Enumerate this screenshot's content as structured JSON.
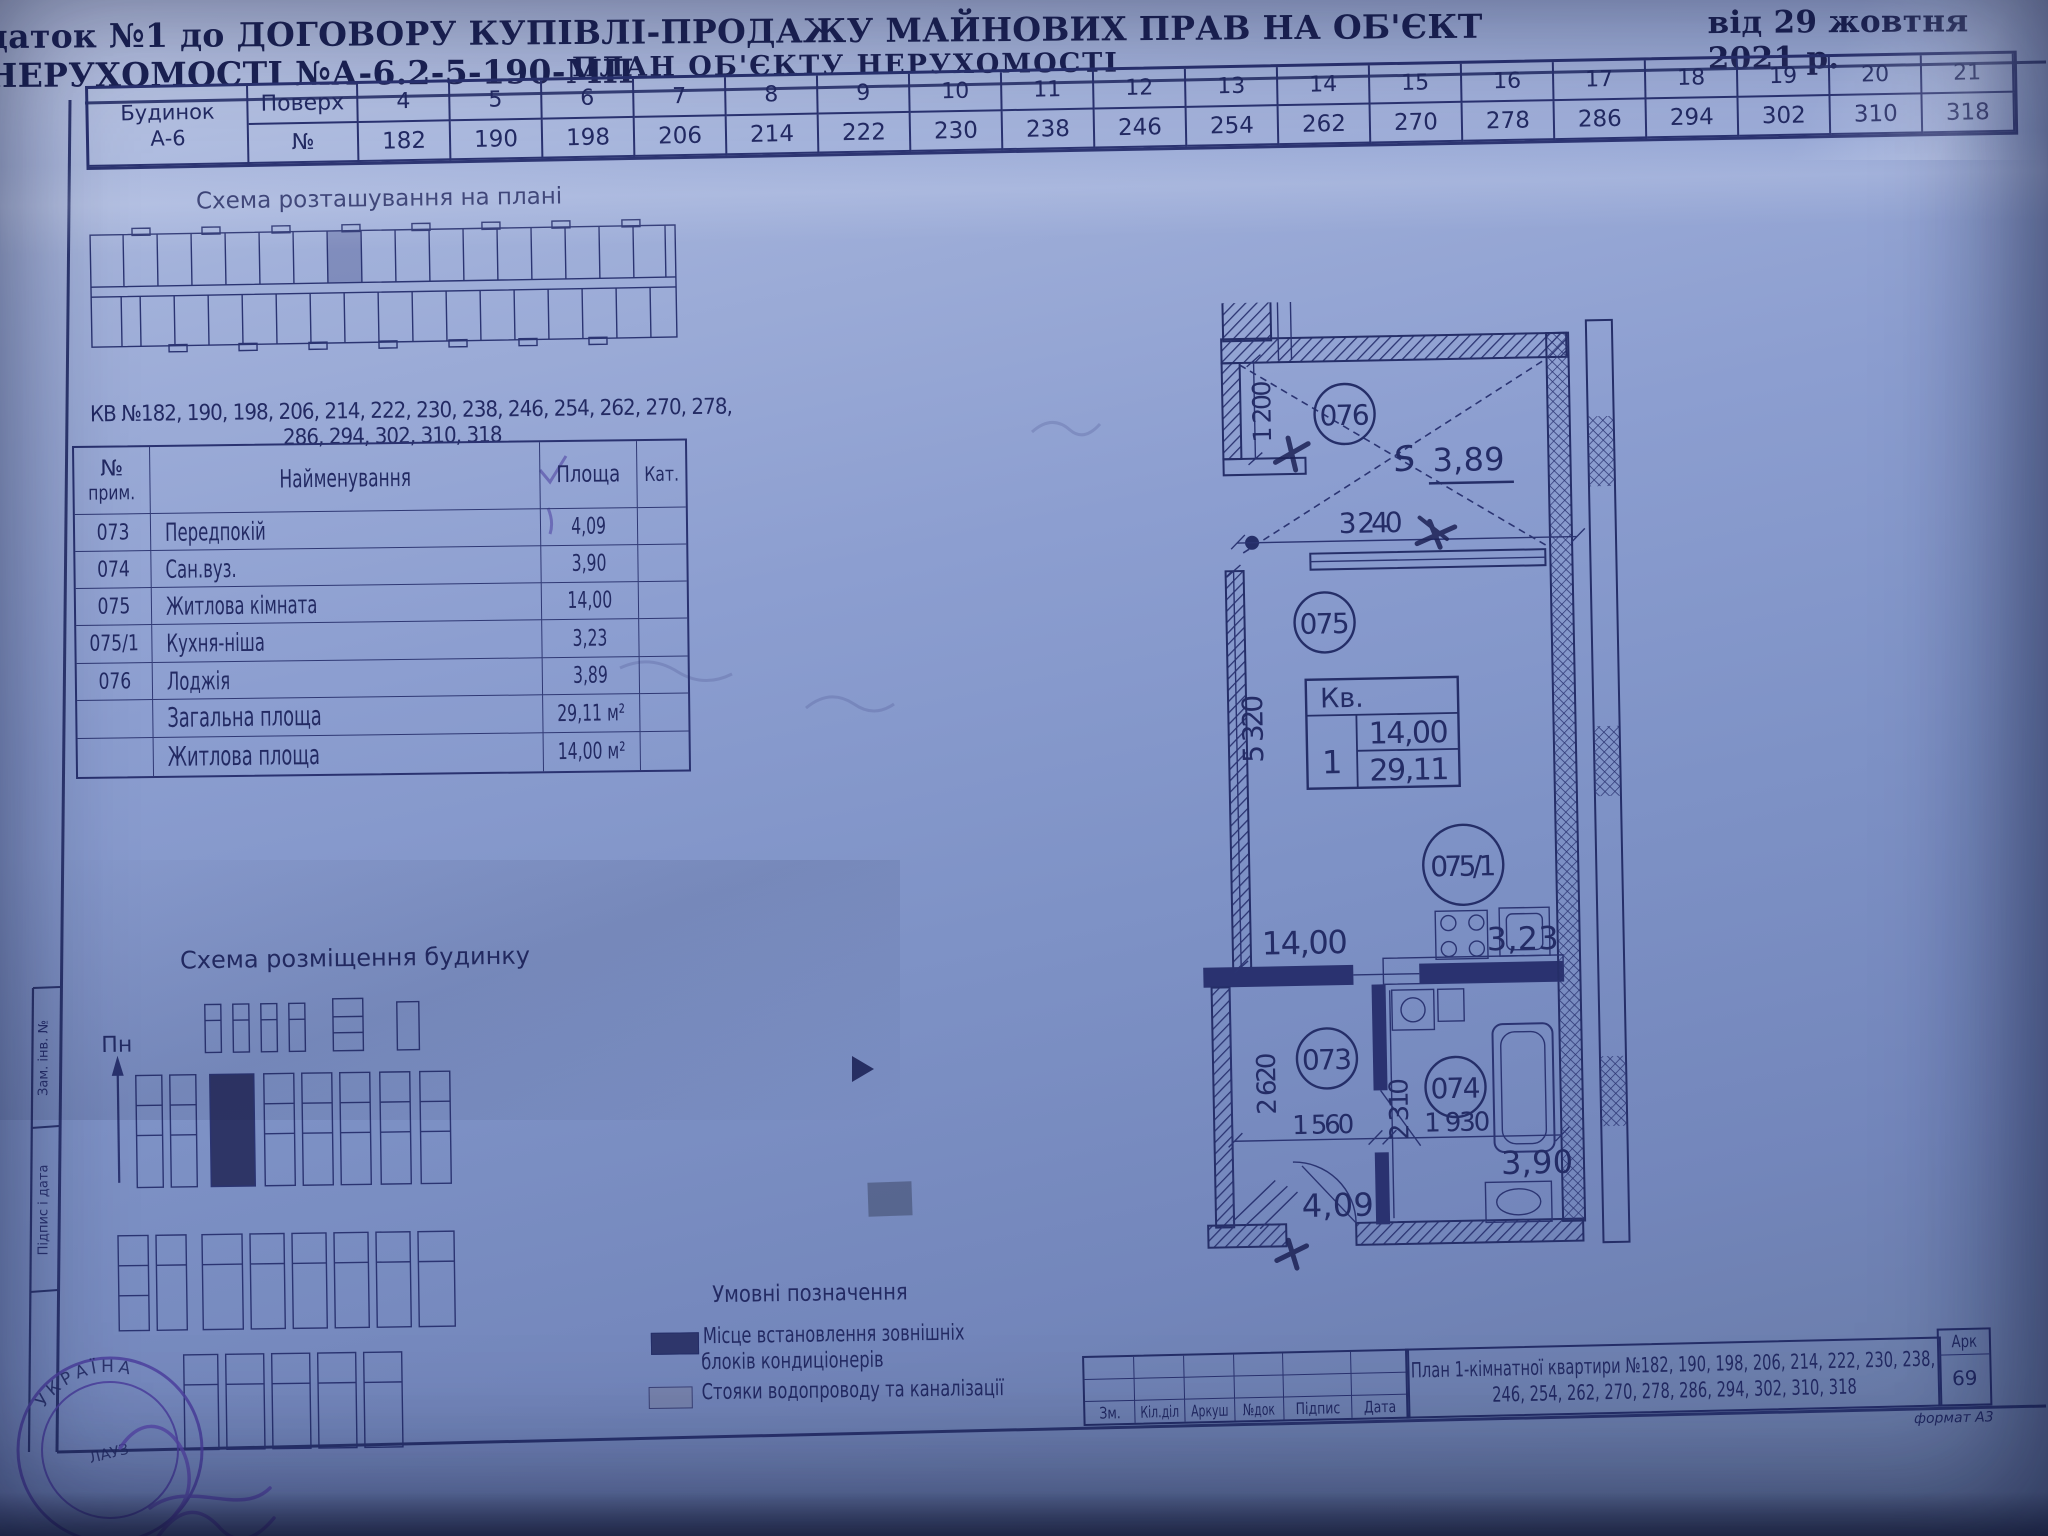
{
  "header": {
    "appendix_line": "даток №1  до ДОГОВОРУ КУПІВЛІ-ПРОДАЖУ МАЙНОВИХ ПРАВ НА ОБ'ЄКТ НЕРУХОМОСТІ №А-6.2-5-190-МП",
    "date_line": "від 29 жовтня 2021 р.",
    "plan_title": "ПЛАН ОБ'ЄКТУ НЕРУХОМОСТІ"
  },
  "floors_table": {
    "building_label": "Будинок",
    "building_value": "А-6",
    "floor_label": "Поверх",
    "num_label": "№",
    "columns": [
      {
        "floor": "4",
        "num": "182"
      },
      {
        "floor": "5",
        "num": "190"
      },
      {
        "floor": "6",
        "num": "198"
      },
      {
        "floor": "7",
        "num": "206"
      },
      {
        "floor": "8",
        "num": "214"
      },
      {
        "floor": "9",
        "num": "222"
      },
      {
        "floor": "10",
        "num": "230"
      },
      {
        "floor": "11",
        "num": "238"
      },
      {
        "floor": "12",
        "num": "246"
      },
      {
        "floor": "13",
        "num": "254"
      },
      {
        "floor": "14",
        "num": "262"
      },
      {
        "floor": "15",
        "num": "270"
      },
      {
        "floor": "16",
        "num": "278"
      },
      {
        "floor": "17",
        "num": "286"
      },
      {
        "floor": "18",
        "num": "294"
      },
      {
        "floor": "19",
        "num": "302"
      },
      {
        "floor": "20",
        "num": "310"
      },
      {
        "floor": "21",
        "num": "318"
      }
    ]
  },
  "location_scheme": {
    "title": "Схема розташування на плані"
  },
  "kv_list": {
    "line1": "КВ  №182, 190, 198, 206, 214, 222, 230, 238, 246, 254, 262, 270, 278,",
    "line2": "286, 294, 302, 310, 318"
  },
  "rooms_table": {
    "header": {
      "num_line1": "№",
      "num_line2": "прим.",
      "name": "Найменування",
      "area": "Площа",
      "cat": "Кат."
    },
    "rows": [
      {
        "num": "073",
        "name": "Передпокій",
        "area": "4,09"
      },
      {
        "num": "074",
        "name": "Сан.вуз.",
        "area": "3,90"
      },
      {
        "num": "075",
        "name": "Житлова кімната",
        "area": "14,00"
      },
      {
        "num": "075/1",
        "name": "Кухня-ніша",
        "area": "3,23"
      },
      {
        "num": "076",
        "name": "Лоджія",
        "area": "3,89"
      }
    ],
    "totals": [
      {
        "label": "Загальна площа",
        "value": "29,11 м²"
      },
      {
        "label": "Житлова площа",
        "value": "14,00 м²"
      }
    ]
  },
  "site_scheme": {
    "title": "Схема розміщення будинку",
    "north_label": "Пн"
  },
  "apartment_plan": {
    "room_numbers": {
      "loggia": "076",
      "living": "075",
      "kitchen": "075/1",
      "hall": "073",
      "bath": "074"
    },
    "areas": {
      "loggia": "3,89",
      "living": "14,00",
      "kitchen": "3,23",
      "hall": "4,09",
      "bath": "3,90"
    },
    "dims": {
      "loggia_depth": "1 200",
      "loggia_width": "3 240",
      "living_depth": "5 320",
      "hall_depth": "2 620",
      "hall_width": "1 560",
      "bath_depth": "2 310",
      "bath_width": "1 930"
    },
    "kv_box": {
      "label": "Кв.",
      "number": "1",
      "living_area": "14,00",
      "total_area": "29,11"
    },
    "handwritten_prefix": "S"
  },
  "legend": {
    "title": "Умовні позначення",
    "item1_line1": "Місце встановлення зовнішніх",
    "item1_line2": "блоків кондиціонерів",
    "item2": "Стояки водопроводу та каналізації"
  },
  "title_block": {
    "col_labels": [
      "Зм.",
      "Кіл.діл",
      "Аркуш",
      "№док",
      "Підпис",
      "Дата"
    ],
    "plan_line1": "План 1-кімнатної квартири №182, 190, 198, 206, 214, 222, 230, 238,",
    "plan_line2": "246, 254, 262, 270, 278, 286, 294, 302, 310, 318",
    "sheet_label": "Арк",
    "sheet_number": "69",
    "format_note": "формат А3"
  },
  "side_labels": {
    "upper": "Зам. інв. №",
    "lower": "Підпис і дата"
  },
  "stamp": {
    "arc_text": "УКРАЇНА",
    "inner_text": "ЛАУЗ"
  }
}
